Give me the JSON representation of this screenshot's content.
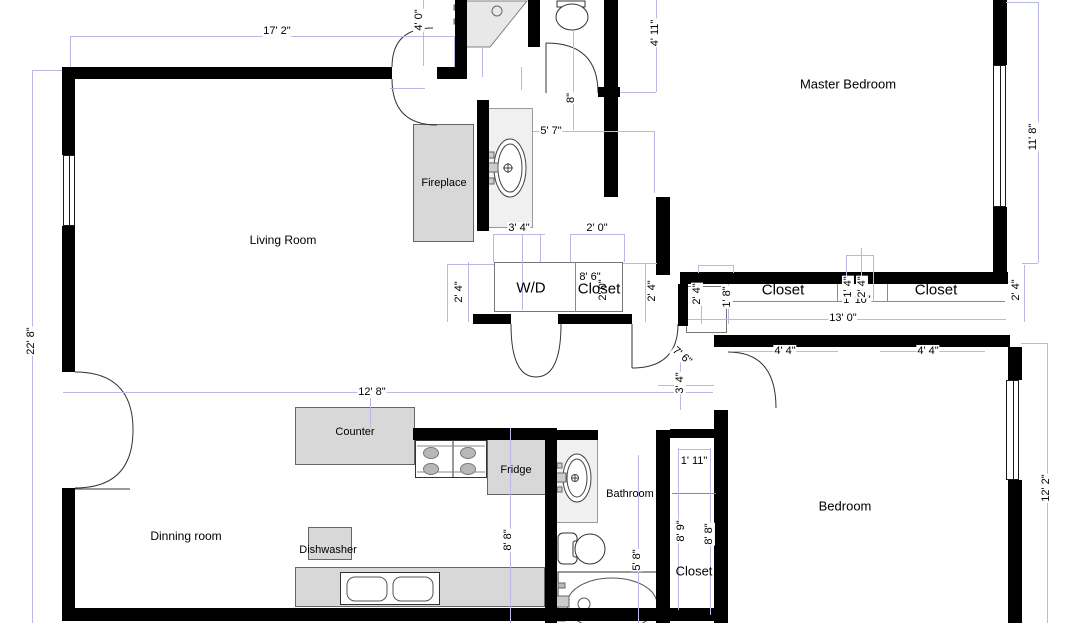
{
  "title": "Apartment Floor Plan",
  "colors": {
    "wall": "#000000",
    "dimension_line": "#b9b9e8",
    "dimension_text": "#000000",
    "furniture_fill": "#d8d8d8",
    "fixture_fill": "#f0f0f0",
    "outline_gray": "#8a8a8a",
    "background": "#ffffff"
  },
  "room_labels": [
    {
      "name": "living-room-label",
      "text": "Living Room",
      "x": 283,
      "y": 240,
      "size": 12
    },
    {
      "name": "master-bedroom-label",
      "text": "Master Bedroom",
      "x": 848,
      "y": 84,
      "size": 13
    },
    {
      "name": "bedroom-label",
      "text": "Bedroom",
      "x": 845,
      "y": 506,
      "size": 13
    },
    {
      "name": "dining-room-label",
      "text": "Dinning room",
      "x": 186,
      "y": 536,
      "size": 12
    },
    {
      "name": "bathroom-label",
      "text": "Bathroom",
      "x": 630,
      "y": 494,
      "size": 11
    },
    {
      "name": "fireplace-label",
      "text": "Fireplace",
      "x": 444,
      "y": 183,
      "size": 11
    },
    {
      "name": "counter-label",
      "text": "Counter",
      "x": 355,
      "y": 432,
      "size": 11
    },
    {
      "name": "fridge-label",
      "text": "Fridge",
      "x": 516,
      "y": 470,
      "size": 11
    },
    {
      "name": "dishwasher-label",
      "text": "Dishwasher",
      "x": 328,
      "y": 550,
      "size": 11
    },
    {
      "name": "washer-dryer-label",
      "text": "W/D",
      "x": 531,
      "y": 288,
      "size": 15
    },
    {
      "name": "closet-wd-label",
      "text": "Closet",
      "x": 599,
      "y": 289,
      "size": 15
    },
    {
      "name": "closet-master-1-label",
      "text": "Closet",
      "x": 783,
      "y": 290,
      "size": 15
    },
    {
      "name": "closet-master-2-label",
      "text": "Closet",
      "x": 936,
      "y": 290,
      "size": 15
    },
    {
      "name": "closet-hall-label",
      "text": "Closet",
      "x": 694,
      "y": 571,
      "size": 13
    }
  ],
  "dim_labels": [
    {
      "text": "17' 2\"",
      "x": 277,
      "y": 31,
      "rot": 0
    },
    {
      "text": "4' 0\"",
      "x": 419,
      "y": 20,
      "rot": -90
    },
    {
      "text": "4' 11\"",
      "x": 655,
      "y": 33,
      "rot": -90
    },
    {
      "text": "11' 8\"",
      "x": 1033,
      "y": 137,
      "rot": -90
    },
    {
      "text": "22' 8\"",
      "x": 31,
      "y": 341,
      "rot": -90
    },
    {
      "text": "5' 7\"",
      "x": 551,
      "y": 131,
      "rot": 0
    },
    {
      "text": "8\"",
      "x": 571,
      "y": 98,
      "rot": -90
    },
    {
      "text": "3' 4\"",
      "x": 519,
      "y": 228,
      "rot": 0
    },
    {
      "text": "2' 0\"",
      "x": 597,
      "y": 228,
      "rot": 0
    },
    {
      "text": "2' 4\"",
      "x": 459,
      "y": 292,
      "rot": -90
    },
    {
      "text": "2' 4\"",
      "x": 652,
      "y": 291,
      "rot": -90
    },
    {
      "text": "8' 6\"",
      "x": 590,
      "y": 277,
      "rot": 0
    },
    {
      "text": "2' 0\"",
      "x": 603,
      "y": 290,
      "rot": -90
    },
    {
      "text": "2' 4\"",
      "x": 697,
      "y": 294,
      "rot": -90
    },
    {
      "text": "1' 8\"",
      "x": 727,
      "y": 297,
      "rot": -90
    },
    {
      "text": "1' 10\"",
      "x": 857,
      "y": 300,
      "rot": 0
    },
    {
      "text": "1' 4\"",
      "x": 848,
      "y": 287,
      "rot": -90
    },
    {
      "text": "2' 4\"",
      "x": 862,
      "y": 287,
      "rot": -90
    },
    {
      "text": "13' 0\"",
      "x": 843,
      "y": 318,
      "rot": 0
    },
    {
      "text": "4' 4\"",
      "x": 785,
      "y": 351,
      "rot": 0
    },
    {
      "text": "4' 4\"",
      "x": 928,
      "y": 351,
      "rot": 0
    },
    {
      "text": "2' 4\"",
      "x": 1016,
      "y": 290,
      "rot": -90
    },
    {
      "text": "12' 2\"",
      "x": 1046,
      "y": 488,
      "rot": -90
    },
    {
      "text": "7' 6\"",
      "x": 682,
      "y": 356,
      "rot": 40
    },
    {
      "text": "3' 4\"",
      "x": 680,
      "y": 383,
      "rot": -90
    },
    {
      "text": "12' 8\"",
      "x": 372,
      "y": 392,
      "rot": 0
    },
    {
      "text": "1' 11\"",
      "x": 694,
      "y": 461,
      "rot": 0
    },
    {
      "text": "8' 9\"",
      "x": 681,
      "y": 531,
      "rot": -90
    },
    {
      "text": "8' 8\"",
      "x": 709,
      "y": 534,
      "rot": -90
    },
    {
      "text": "5' 8\"",
      "x": 637,
      "y": 560,
      "rot": -90
    },
    {
      "text": "8' 8\"",
      "x": 508,
      "y": 540,
      "rot": -90
    }
  ],
  "walls": [
    [
      68,
      67,
      324,
      12
    ],
    [
      437,
      67,
      30,
      12
    ],
    [
      455,
      0,
      12,
      79
    ],
    [
      477,
      100,
      12,
      131
    ],
    [
      528,
      0,
      12,
      47
    ],
    [
      604,
      0,
      14,
      87
    ],
    [
      598,
      87,
      22,
      10
    ],
    [
      604,
      97,
      14,
      100
    ],
    [
      656,
      197,
      14,
      78
    ],
    [
      680,
      272,
      328,
      12
    ],
    [
      678,
      284,
      10,
      42
    ],
    [
      473,
      314,
      38,
      10
    ],
    [
      558,
      314,
      74,
      10
    ],
    [
      714,
      335,
      296,
      12
    ],
    [
      714,
      410,
      14,
      213
    ],
    [
      62,
      67,
      13,
      88
    ],
    [
      62,
      226,
      13,
      146
    ],
    [
      62,
      488,
      13,
      125
    ],
    [
      62,
      608,
      666,
      13
    ],
    [
      413,
      428,
      144,
      12
    ],
    [
      545,
      440,
      12,
      183
    ],
    [
      553,
      430,
      45,
      10
    ],
    [
      656,
      430,
      14,
      193
    ],
    [
      670,
      429,
      46,
      9
    ],
    [
      993,
      0,
      14,
      65
    ],
    [
      993,
      207,
      14,
      77
    ],
    [
      1008,
      347,
      14,
      33
    ],
    [
      1008,
      480,
      14,
      143
    ]
  ],
  "windows": [
    [
      63,
      155,
      12,
      71
    ],
    [
      993,
      65,
      13,
      142
    ],
    [
      1006,
      380,
      13,
      100
    ]
  ],
  "gray_lines": [
    [
      727,
      301,
      278,
      1
    ],
    [
      837,
      284,
      1,
      18
    ],
    [
      887,
      284,
      1,
      18
    ],
    [
      672,
      493,
      44,
      1
    ],
    [
      575,
      262,
      1,
      50
    ]
  ],
  "boxes": [
    {
      "name": "fireplace",
      "cls": "furn",
      "r": [
        413,
        124,
        61,
        118
      ]
    },
    {
      "name": "kitchen-counter",
      "cls": "furn",
      "r": [
        295,
        407,
        120,
        58
      ]
    },
    {
      "name": "fridge",
      "cls": "furn",
      "r": [
        487,
        437,
        60,
        58
      ]
    },
    {
      "name": "dishwasher",
      "cls": "furn",
      "r": [
        308,
        527,
        44,
        33
      ]
    },
    {
      "name": "kitchen-counter-bottom",
      "cls": "furn",
      "r": [
        295,
        567,
        250,
        40
      ]
    },
    {
      "name": "hall-vanity",
      "cls": "light",
      "r": [
        486,
        108,
        47,
        120
      ]
    },
    {
      "name": "bathroom-vanity",
      "cls": "light",
      "r": [
        555,
        438,
        43,
        85
      ]
    },
    {
      "name": "stove",
      "cls": "white",
      "r": [
        415,
        440,
        72,
        38
      ]
    },
    {
      "name": "kitchen-sink",
      "cls": "white",
      "r": [
        340,
        572,
        100,
        33
      ]
    },
    {
      "name": "washer-dryer-closet-box",
      "cls": "outline",
      "r": [
        494,
        262,
        129,
        50
      ]
    },
    {
      "name": "small-closet-box",
      "cls": "outline",
      "r": [
        686,
        286,
        41,
        47
      ]
    }
  ],
  "dim_lines": [
    [
      70,
      36,
      385,
      1
    ],
    [
      70,
      36,
      1,
      31
    ],
    [
      454,
      36,
      1,
      31
    ],
    [
      423,
      0,
      1,
      66
    ],
    [
      390,
      88,
      35,
      1
    ],
    [
      656,
      0,
      1,
      92
    ],
    [
      620,
      92,
      36,
      1
    ],
    [
      1038,
      2,
      1,
      261
    ],
    [
      1006,
      2,
      32,
      1
    ],
    [
      1022,
      263,
      16,
      1
    ],
    [
      32,
      70,
      1,
      553
    ],
    [
      32,
      70,
      30,
      1
    ],
    [
      1047,
      343,
      1,
      280
    ],
    [
      1021,
      343,
      26,
      1
    ],
    [
      533,
      131,
      122,
      1
    ],
    [
      654,
      131,
      1,
      62
    ],
    [
      573,
      30,
      1,
      100
    ],
    [
      493,
      234,
      52,
      1
    ],
    [
      493,
      234,
      1,
      28
    ],
    [
      540,
      234,
      1,
      28
    ],
    [
      570,
      234,
      55,
      1
    ],
    [
      570,
      234,
      1,
      28
    ],
    [
      624,
      234,
      1,
      28
    ],
    [
      447,
      264,
      47,
      1
    ],
    [
      447,
      264,
      1,
      58
    ],
    [
      468,
      262,
      1,
      60
    ],
    [
      645,
      263,
      1,
      59
    ],
    [
      623,
      263,
      34,
      1
    ],
    [
      698,
      265,
      35,
      1
    ],
    [
      698,
      265,
      1,
      8
    ],
    [
      733,
      265,
      1,
      8
    ],
    [
      701,
      284,
      1,
      40
    ],
    [
      728,
      284,
      1,
      40
    ],
    [
      846,
      255,
      1,
      47
    ],
    [
      861,
      248,
      1,
      54
    ],
    [
      873,
      255,
      1,
      47
    ],
    [
      846,
      255,
      27,
      1
    ],
    [
      688,
      319,
      318,
      1
    ],
    [
      733,
      351,
      105,
      1
    ],
    [
      880,
      351,
      105,
      1
    ],
    [
      63,
      392,
      650,
      1
    ],
    [
      370,
      392,
      1,
      36
    ],
    [
      680,
      347,
      1,
      63
    ],
    [
      658,
      385,
      56,
      1
    ],
    [
      678,
      448,
      1,
      162
    ],
    [
      710,
      448,
      1,
      167
    ],
    [
      678,
      449,
      32,
      1
    ],
    [
      638,
      455,
      1,
      168
    ],
    [
      510,
      428,
      1,
      195
    ],
    [
      1024,
      265,
      1,
      57
    ],
    [
      482,
      47,
      1,
      30
    ],
    [
      521,
      67,
      1,
      23
    ],
    [
      522,
      234,
      1,
      76
    ]
  ],
  "doors": [
    {
      "name": "door-living-entry-arc",
      "d": "M392 79 Q392 125 437 125"
    },
    {
      "name": "door-entry-upper-arc",
      "d": "M433 28 Q392 28 392 67"
    },
    {
      "name": "door-entry-leaf",
      "d": "M546 43 L546 93"
    },
    {
      "name": "door-entry-arc",
      "d": "M546 43 Q598 43 598 93"
    },
    {
      "name": "door-hall-arc",
      "d": "M632 368 Q678 368 678 324"
    },
    {
      "name": "door-hall-leaf",
      "d": "M632 324 L632 368"
    },
    {
      "name": "door-bedroom-arc",
      "d": "M728 352 Q776 352 776 408"
    },
    {
      "name": "door-wd-left-arc",
      "d": "M511 324 Q511 377 536 377"
    },
    {
      "name": "door-wd-right-arc",
      "d": "M561 324 Q561 377 536 377"
    },
    {
      "name": "door-french-top-arc",
      "d": "M75 372 Q133 372 133 430"
    },
    {
      "name": "door-french-bottom-arc",
      "d": "M75 488 Q133 488 133 430"
    },
    {
      "name": "door-french-leaf",
      "d": "M68 489 L130 489"
    }
  ],
  "fixtures": [
    {
      "name": "corner-shower",
      "t": "path",
      "d": "M463 1 L527 1 L490 47 L463 47 Z",
      "f": "#e8e8e8",
      "s": "#808080"
    },
    {
      "name": "shower-drain",
      "t": "circle",
      "cx": 497,
      "cy": 11,
      "r": 5,
      "f": "none",
      "s": "#666"
    },
    {
      "name": "shower-handle",
      "t": "rect",
      "x": 454,
      "y": 5,
      "w": 9,
      "h": 5,
      "f": "#999",
      "s": "#666"
    },
    {
      "name": "shower-handle",
      "t": "rect",
      "x": 454,
      "y": 19,
      "w": 9,
      "h": 5,
      "f": "#999",
      "s": "#666"
    },
    {
      "name": "toilet-top-tank",
      "t": "rect",
      "x": 557,
      "y": 1,
      "w": 28,
      "h": 6,
      "f": "#fff",
      "s": "#333"
    },
    {
      "name": "toilet-top-bowl",
      "t": "ellipse",
      "cx": 572,
      "cy": 17,
      "rx": 16,
      "ry": 13,
      "f": "#fff",
      "s": "#333"
    },
    {
      "name": "hall-sink-outer",
      "t": "ellipse",
      "cx": 510,
      "cy": 168,
      "rx": 16,
      "ry": 29,
      "f": "#fff",
      "s": "#444"
    },
    {
      "name": "hall-sink-inner",
      "t": "ellipse",
      "cx": 510,
      "cy": 168,
      "rx": 12,
      "ry": 24,
      "f": "none",
      "s": "#444"
    },
    {
      "name": "hall-faucet",
      "t": "rect",
      "x": 487,
      "y": 163,
      "w": 11,
      "h": 9,
      "f": "#ccc",
      "s": "#666"
    },
    {
      "name": "hall-faucet-handle",
      "t": "rect",
      "x": 488,
      "y": 152,
      "w": 6,
      "h": 6,
      "f": "#ccc",
      "s": "#666"
    },
    {
      "name": "hall-faucet-handle",
      "t": "rect",
      "x": 488,
      "y": 178,
      "w": 6,
      "h": 6,
      "f": "#ccc",
      "s": "#666"
    },
    {
      "name": "hall-drain",
      "t": "circle",
      "cx": 508,
      "cy": 168,
      "r": 4,
      "f": "none",
      "s": "#444"
    },
    {
      "name": "hall-drain-cross",
      "t": "line",
      "x1": 503,
      "y1": 168,
      "x2": 513,
      "y2": 168,
      "s": "#444"
    },
    {
      "name": "hall-drain-cross",
      "t": "line",
      "x1": 508,
      "y1": 163,
      "x2": 508,
      "y2": 173,
      "s": "#444"
    },
    {
      "name": "stove-divider",
      "t": "line",
      "x1": 453,
      "y1": 441,
      "x2": 453,
      "y2": 477,
      "s": "#333"
    },
    {
      "name": "stove-frame-line",
      "t": "line",
      "x1": 417,
      "y1": 446,
      "x2": 485,
      "y2": 446,
      "s": "#888"
    },
    {
      "name": "stove-frame-line",
      "t": "line",
      "x1": 417,
      "y1": 472,
      "x2": 485,
      "y2": 472,
      "s": "#888"
    },
    {
      "name": "stove-burner",
      "t": "ellipse",
      "cx": 431,
      "cy": 453,
      "rx": 7.5,
      "ry": 5.5,
      "f": "#b8b8b8",
      "s": "#777"
    },
    {
      "name": "stove-burner",
      "t": "ellipse",
      "cx": 431,
      "cy": 469,
      "rx": 7.5,
      "ry": 5.5,
      "f": "#b8b8b8",
      "s": "#777"
    },
    {
      "name": "stove-burner",
      "t": "ellipse",
      "cx": 468,
      "cy": 453,
      "rx": 7.5,
      "ry": 5.5,
      "f": "#b8b8b8",
      "s": "#777"
    },
    {
      "name": "stove-burner",
      "t": "ellipse",
      "cx": 468,
      "cy": 469,
      "rx": 7.5,
      "ry": 5.5,
      "f": "#b8b8b8",
      "s": "#777"
    },
    {
      "name": "sink-bowl",
      "t": "rect",
      "x": 347,
      "y": 577,
      "w": 40,
      "h": 24,
      "rx": 8,
      "f": "#fff",
      "s": "#555"
    },
    {
      "name": "sink-bowl",
      "t": "rect",
      "x": 393,
      "y": 577,
      "w": 40,
      "h": 24,
      "rx": 8,
      "f": "#fff",
      "s": "#555"
    },
    {
      "name": "bath-sink-outer",
      "t": "ellipse",
      "cx": 577,
      "cy": 478,
      "rx": 14,
      "ry": 24,
      "f": "#fff",
      "s": "#444"
    },
    {
      "name": "bath-sink-inner",
      "t": "ellipse",
      "cx": 577,
      "cy": 478,
      "rx": 10,
      "ry": 19,
      "f": "none",
      "s": "#444"
    },
    {
      "name": "bath-faucet",
      "t": "rect",
      "x": 556,
      "y": 473,
      "w": 10,
      "h": 9,
      "f": "#ccc",
      "s": "#666"
    },
    {
      "name": "bath-faucet-handle",
      "t": "rect",
      "x": 557,
      "y": 463,
      "w": 5,
      "h": 5,
      "f": "#ccc",
      "s": "#666"
    },
    {
      "name": "bath-faucet-handle",
      "t": "rect",
      "x": 557,
      "y": 487,
      "w": 5,
      "h": 5,
      "f": "#ccc",
      "s": "#666"
    },
    {
      "name": "bath-drain",
      "t": "circle",
      "cx": 575,
      "cy": 478,
      "r": 3.5,
      "f": "none",
      "s": "#444"
    },
    {
      "name": "bath-drain-cross",
      "t": "line",
      "x1": 571,
      "y1": 478,
      "x2": 579,
      "y2": 478,
      "s": "#444"
    },
    {
      "name": "bath-drain-cross",
      "t": "line",
      "x1": 575,
      "y1": 474,
      "x2": 575,
      "y2": 482,
      "s": "#444"
    },
    {
      "name": "toilet-tank",
      "t": "rect",
      "x": 558,
      "y": 533,
      "w": 19,
      "h": 31,
      "rx": 5,
      "f": "#fff",
      "s": "#333"
    },
    {
      "name": "toilet-seat",
      "t": "rect",
      "x": 573,
      "y": 541,
      "w": 7,
      "h": 16,
      "rx": 2,
      "f": "#fff",
      "s": "#333"
    },
    {
      "name": "toilet-bowl",
      "t": "circle",
      "cx": 590,
      "cy": 549,
      "r": 15,
      "f": "#fff",
      "s": "#333"
    },
    {
      "name": "bathtub",
      "t": "rect",
      "x": 558,
      "y": 572,
      "w": 105,
      "h": 38,
      "f": "#fff",
      "s": "#333"
    },
    {
      "name": "bathtub-basin",
      "t": "ellipse",
      "cx": 612,
      "cy": 604,
      "rx": 45,
      "ry": 26,
      "f": "none",
      "s": "#555"
    },
    {
      "name": "bathtub-spout",
      "t": "rect",
      "x": 556,
      "y": 596,
      "w": 13,
      "h": 11,
      "f": "#ccc",
      "s": "#666"
    },
    {
      "name": "bathtub-knob",
      "t": "circle",
      "cx": 584,
      "cy": 604,
      "r": 6,
      "f": "#fff",
      "s": "#555"
    },
    {
      "name": "bathtub-handle",
      "t": "rect",
      "x": 558,
      "y": 583,
      "w": 7,
      "h": 5,
      "f": "#bbb",
      "s": "#666"
    },
    {
      "name": "bathtub-handle",
      "t": "rect",
      "x": 558,
      "y": 616,
      "w": 7,
      "h": 5,
      "f": "#bbb",
      "s": "#666"
    }
  ]
}
